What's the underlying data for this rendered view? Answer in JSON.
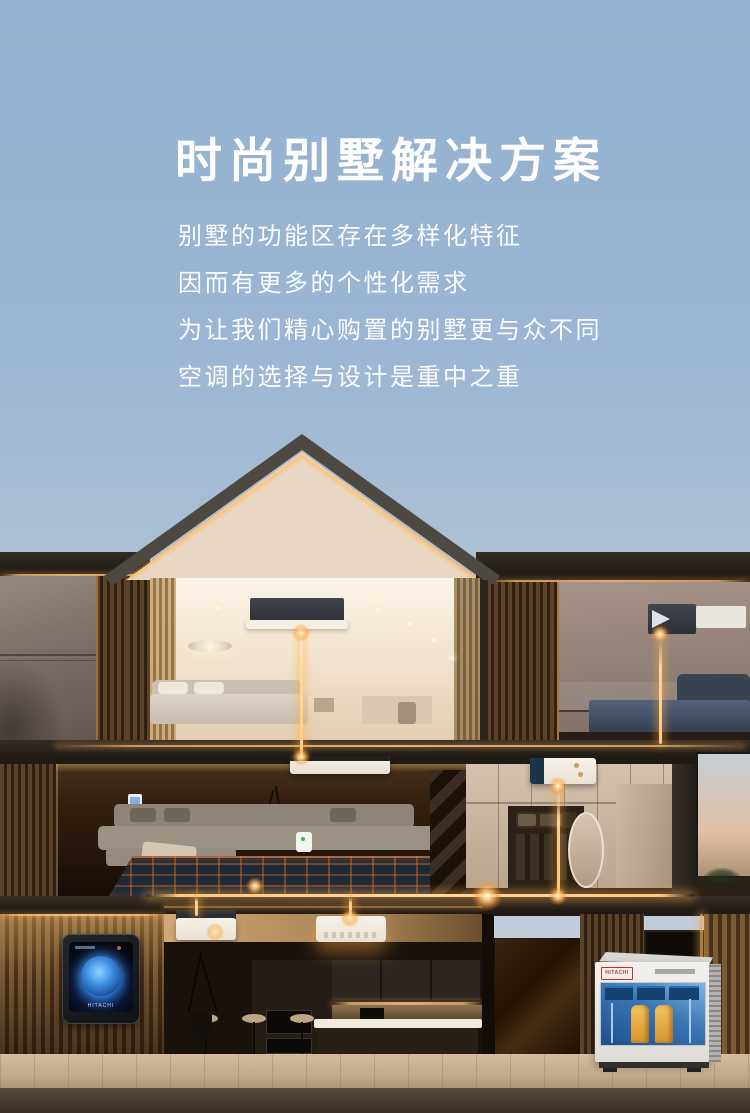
{
  "hero": {
    "title": "时尚别墅解决方案",
    "lines": [
      "别墅的功能区存在多样化特征",
      "因而有更多的个性化需求",
      "为让我们精心购置的别墅更与众不同",
      "空调的选择与设计是重中之重"
    ]
  },
  "devices": {
    "wall_controller_brand": "HITACHI",
    "outdoor_unit_brand": "HITACHI"
  },
  "colors": {
    "sky_top": "#92b1d0",
    "sky_bottom": "#c3cfdc",
    "glow_amber": "#ffc97e",
    "headline_text": "#ffffff",
    "outdoor_logo_red": "#c3322a",
    "controller_screen_blue": "#2e77d4"
  }
}
